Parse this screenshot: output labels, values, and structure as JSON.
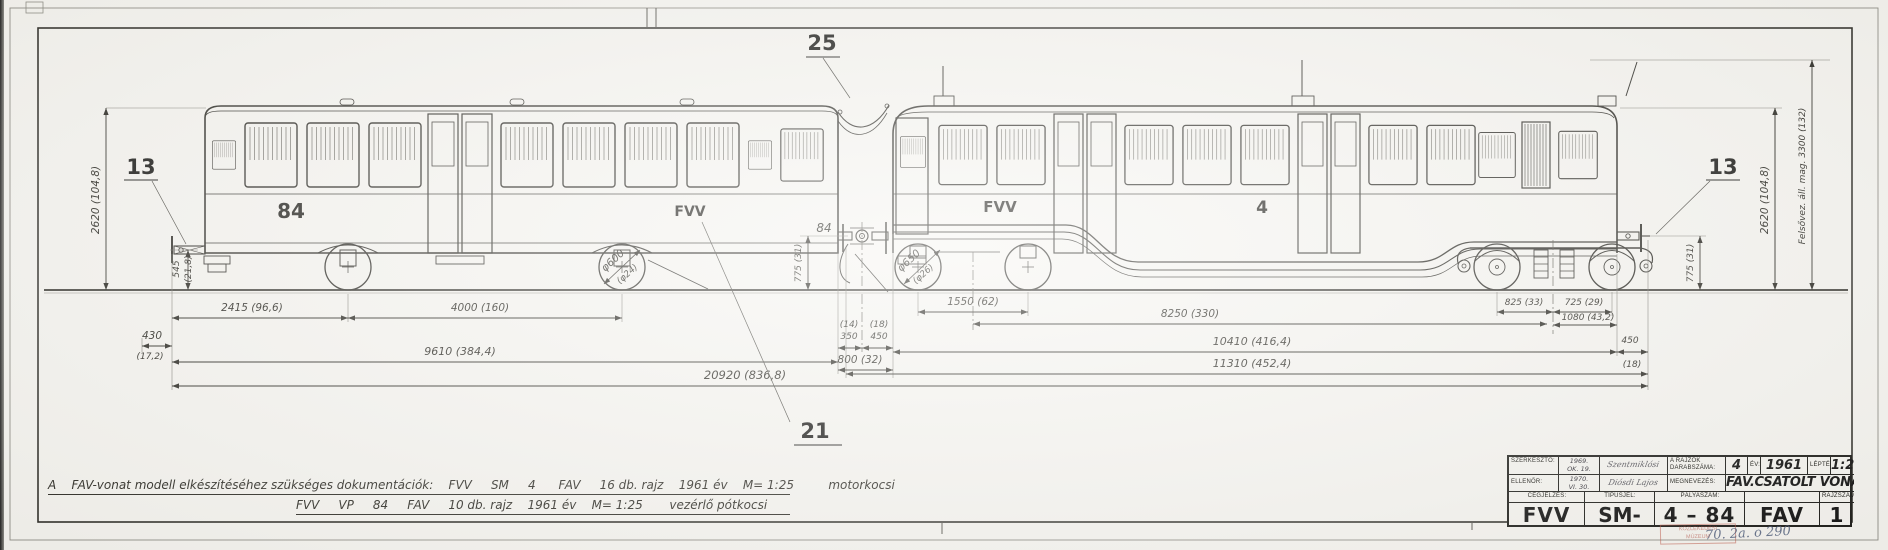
{
  "callouts": {
    "top": "25",
    "left": "13",
    "right": "13",
    "bottom": "21",
    "car_end_number": "84"
  },
  "paint": {
    "left_car_number": "84",
    "left_car_logo": "FVV",
    "right_car_logo": "FVV",
    "right_car_number": "4"
  },
  "dims": {
    "h2415": "2415 (96,6)",
    "h4000": "4000 (160)",
    "h430": "430",
    "h430s": "(17,2)",
    "h9610": "9610 (384,4)",
    "h20920": "20920 (836,8)",
    "m14": "(14)",
    "m350": "350",
    "m18": "(18)",
    "m450": "450",
    "m800": "800 (32)",
    "h1550": "1550 (62)",
    "h8250": "8250 (330)",
    "h825": "825 (33)",
    "h725": "725 (29)",
    "h1080": "1080 (43,2)",
    "r450": "450",
    "r450s": "(18)",
    "h10410": "10410 (416,4)",
    "h11310": "11310 (452,4)",
    "v2620l": "2620 (104,8)",
    "v2620r": "2620 (104,8)",
    "v545": "545",
    "v545s": "(21,8)",
    "v775l": "775 (31)",
    "v775r": "775 (31)",
    "v3300": "Felsővez. áll. mag. 3300 (132)",
    "w600a": "φ600",
    "w600b": "(φ24)",
    "w650a": "φ650",
    "w650b": "(φ26)"
  },
  "notes": {
    "line1": "A    FAV-vonat modell elkészítéséhez szükséges dokumentációk:    FVV     SM     4      FAV     16 db. rajz    1961 év    M= 1:25         motorkocsi",
    "line2": "FVV     VP     84     FAV     10 db. rajz    1961 év    M= 1:25       vezérlő pótkocsi"
  },
  "titleblock": {
    "row1": {
      "label": "SZERKESZTŐ:",
      "date1": "1969.",
      "date2": "OK. 19.",
      "signature": "Szentmiklósi",
      "pieces_label": "A RAJZOK DARABSZÁMA:",
      "pieces": "4",
      "year_label": "ÉV:",
      "year": "1961",
      "scale_label": "LÉPTÉK:",
      "scale": "1:25"
    },
    "row2": {
      "label": "ELLENŐR:",
      "date1": "1970.",
      "date2": "VI. 30.",
      "signature": "Diósdi Lajos",
      "name_label": "MEGNEVEZÉS:",
      "name": "FAV.CSATOLT VONAT"
    },
    "row3": {
      "company_label": "CÉGJELZÉS:",
      "type_label": "TÍPUSJEL:",
      "number_label": "PÁLYASZÁM:",
      "drawing_label": "RAJZSZÁM:"
    },
    "row4": {
      "company": "FVV",
      "type": "SM-VP",
      "number": "4 – 84",
      "series": "FAV",
      "drawing_no": "1"
    }
  },
  "archive": {
    "stamp1": "KÖZLEKEDÉSI",
    "stamp2": "MÚZEUM",
    "inventory_no": "70. 2a. o 290"
  }
}
